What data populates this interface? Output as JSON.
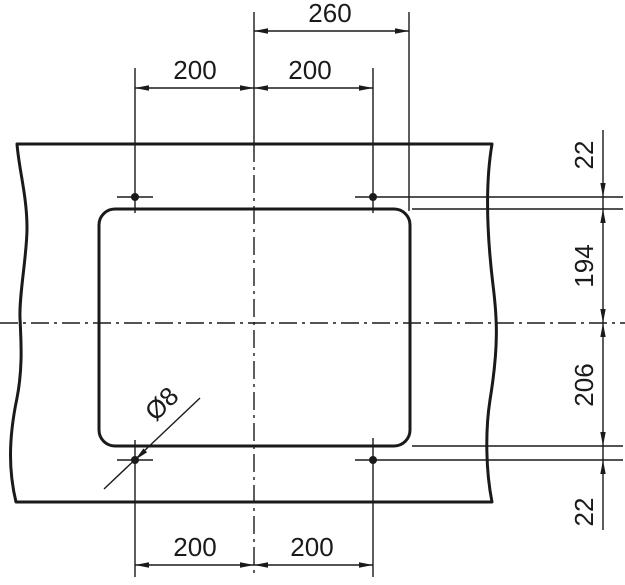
{
  "drawing": {
    "kind": "technical-cutout-dimension-drawing",
    "units": "mm",
    "features": {
      "cutout": "rounded-rectangle cutout in panel",
      "holes": "4 mounting holes",
      "hole_diameter_label": "Ø8"
    },
    "dimensions": {
      "top_half_width": "260",
      "top_hole_left": "200",
      "top_hole_right": "200",
      "right_hole_to_edge_top": "22",
      "right_upper_height": "194",
      "right_lower_height": "206",
      "right_hole_to_edge_bottom": "22",
      "bottom_hole_left": "200",
      "bottom_hole_right": "200"
    },
    "colors": {
      "line": "#1a1a1a",
      "background": "#ffffff"
    }
  }
}
